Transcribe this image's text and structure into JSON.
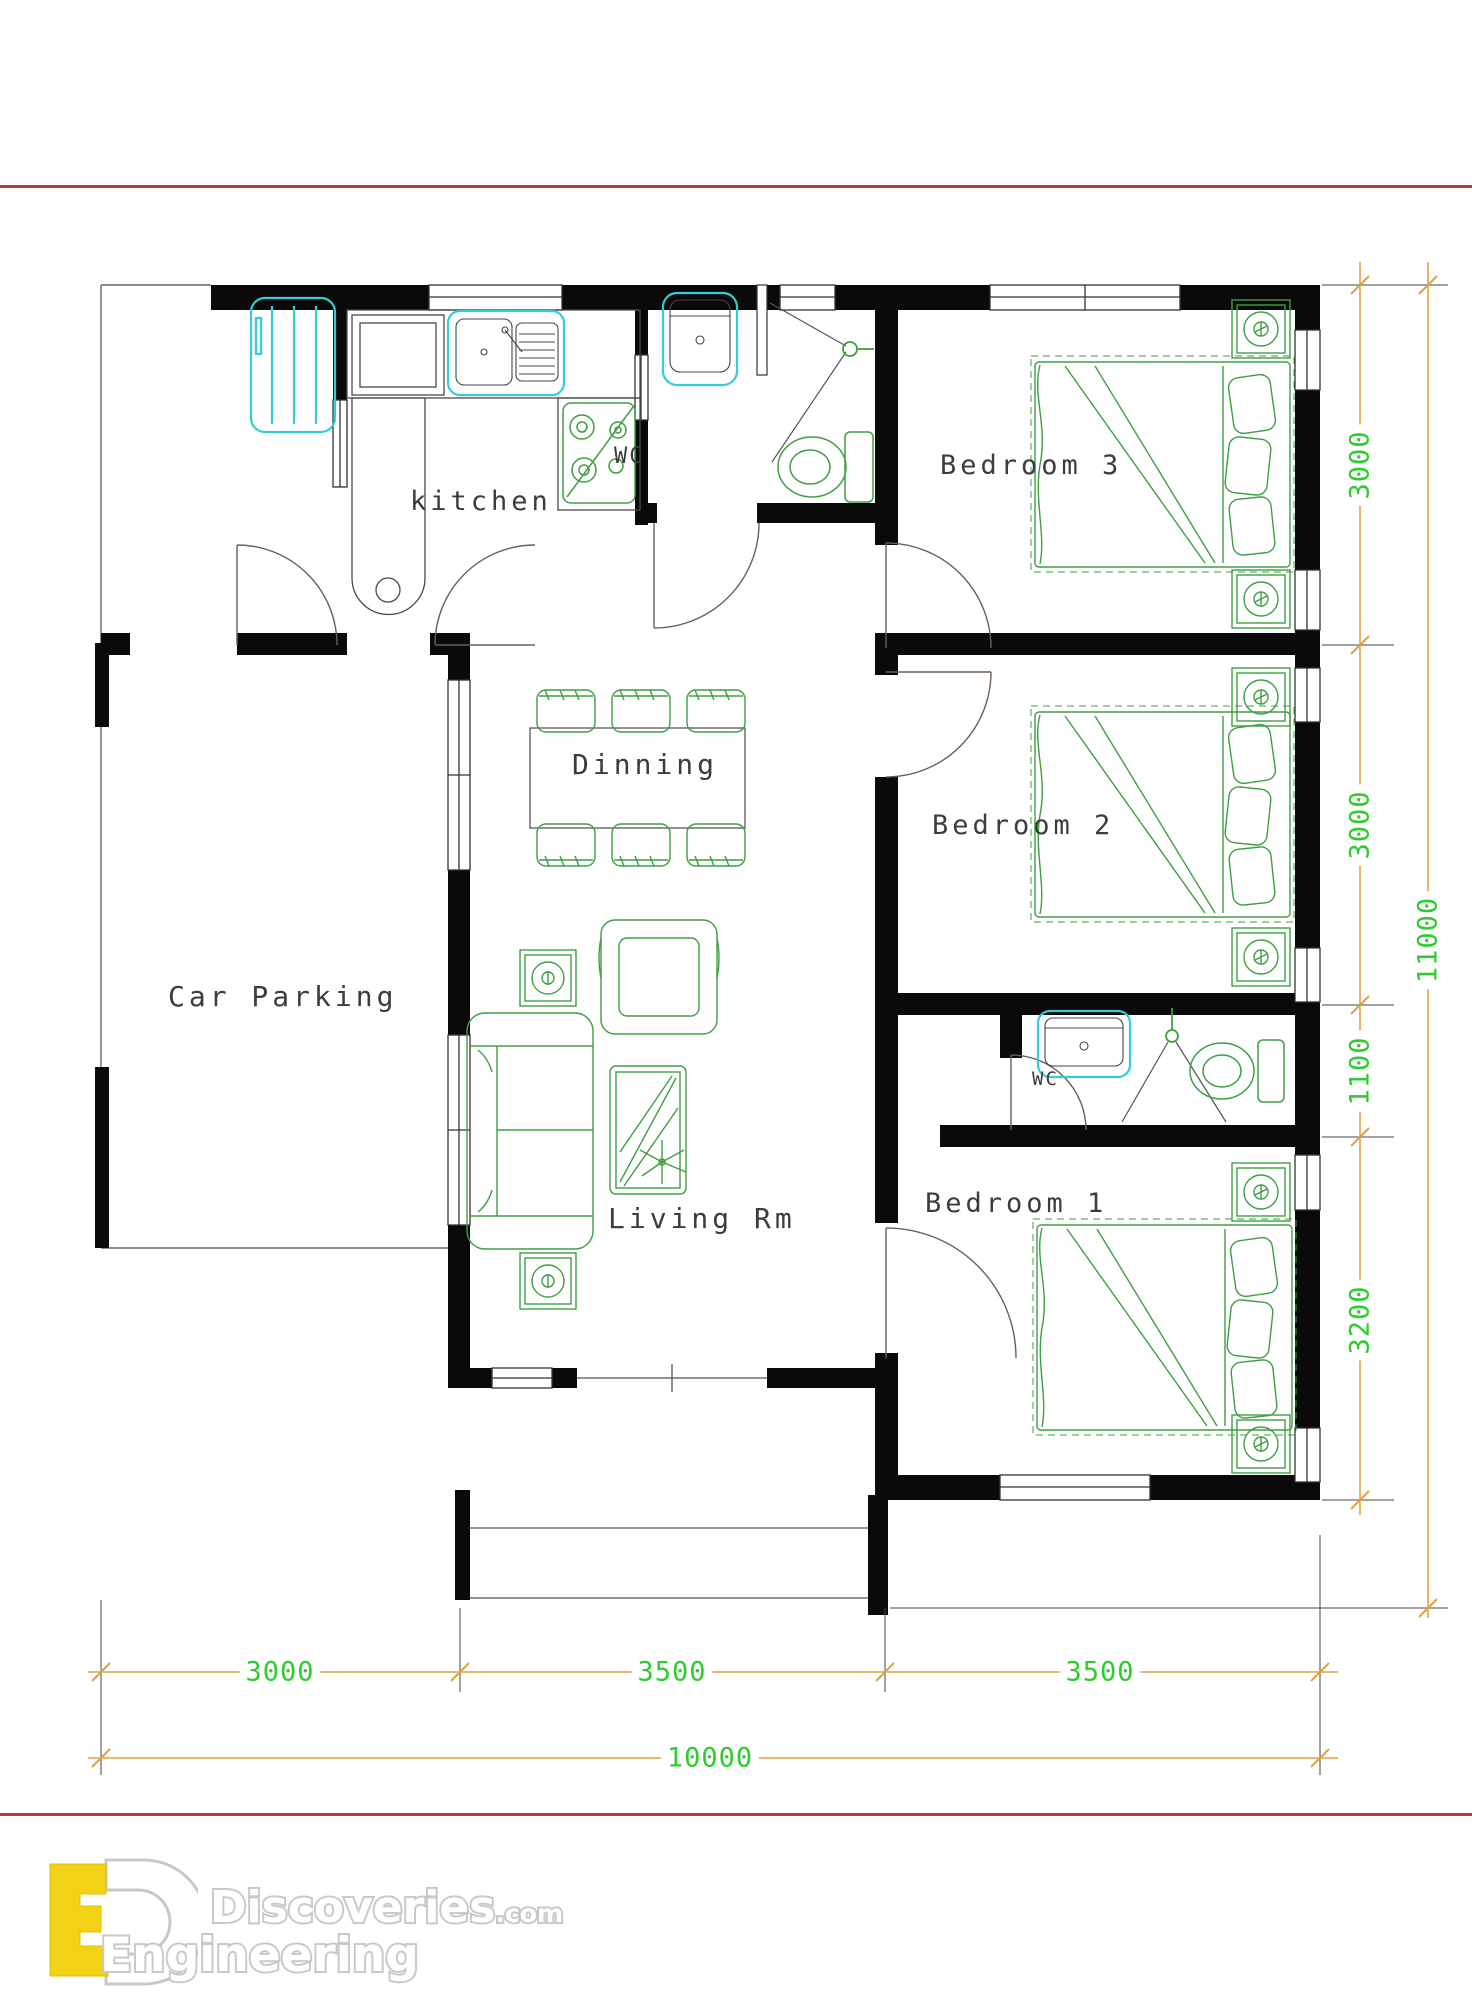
{
  "rooms": {
    "kitchen": "kitchen",
    "wc_top": "WC",
    "bedroom3": "Bedroom 3",
    "dinning": "Dinning",
    "bedroom2": "Bedroom 2",
    "car_parking": "Car Parking",
    "living_room": "Living Rm",
    "wc_bottom": "WC",
    "bedroom1": "Bedroom 1"
  },
  "dims": {
    "right_1": "3000",
    "right_2": "3000",
    "right_3": "1100",
    "right_4": "3200",
    "right_total": "11000",
    "bottom_1": "3000",
    "bottom_2": "3500",
    "bottom_3": "3500",
    "bottom_total": "10000"
  },
  "logo": {
    "line_top": "Discoveries",
    "line_top_suffix": ".com",
    "line_bottom": "Engineering"
  },
  "colors": {
    "wall": "#0a0a0a",
    "furniture_green": "#3f9e42",
    "fixture_cyan": "#36ccd4",
    "dimension_line": "#dfa13f",
    "dimension_text": "#2ecc2e",
    "red_rule": "#b23c3c",
    "label_text": "#3c3c3c"
  }
}
